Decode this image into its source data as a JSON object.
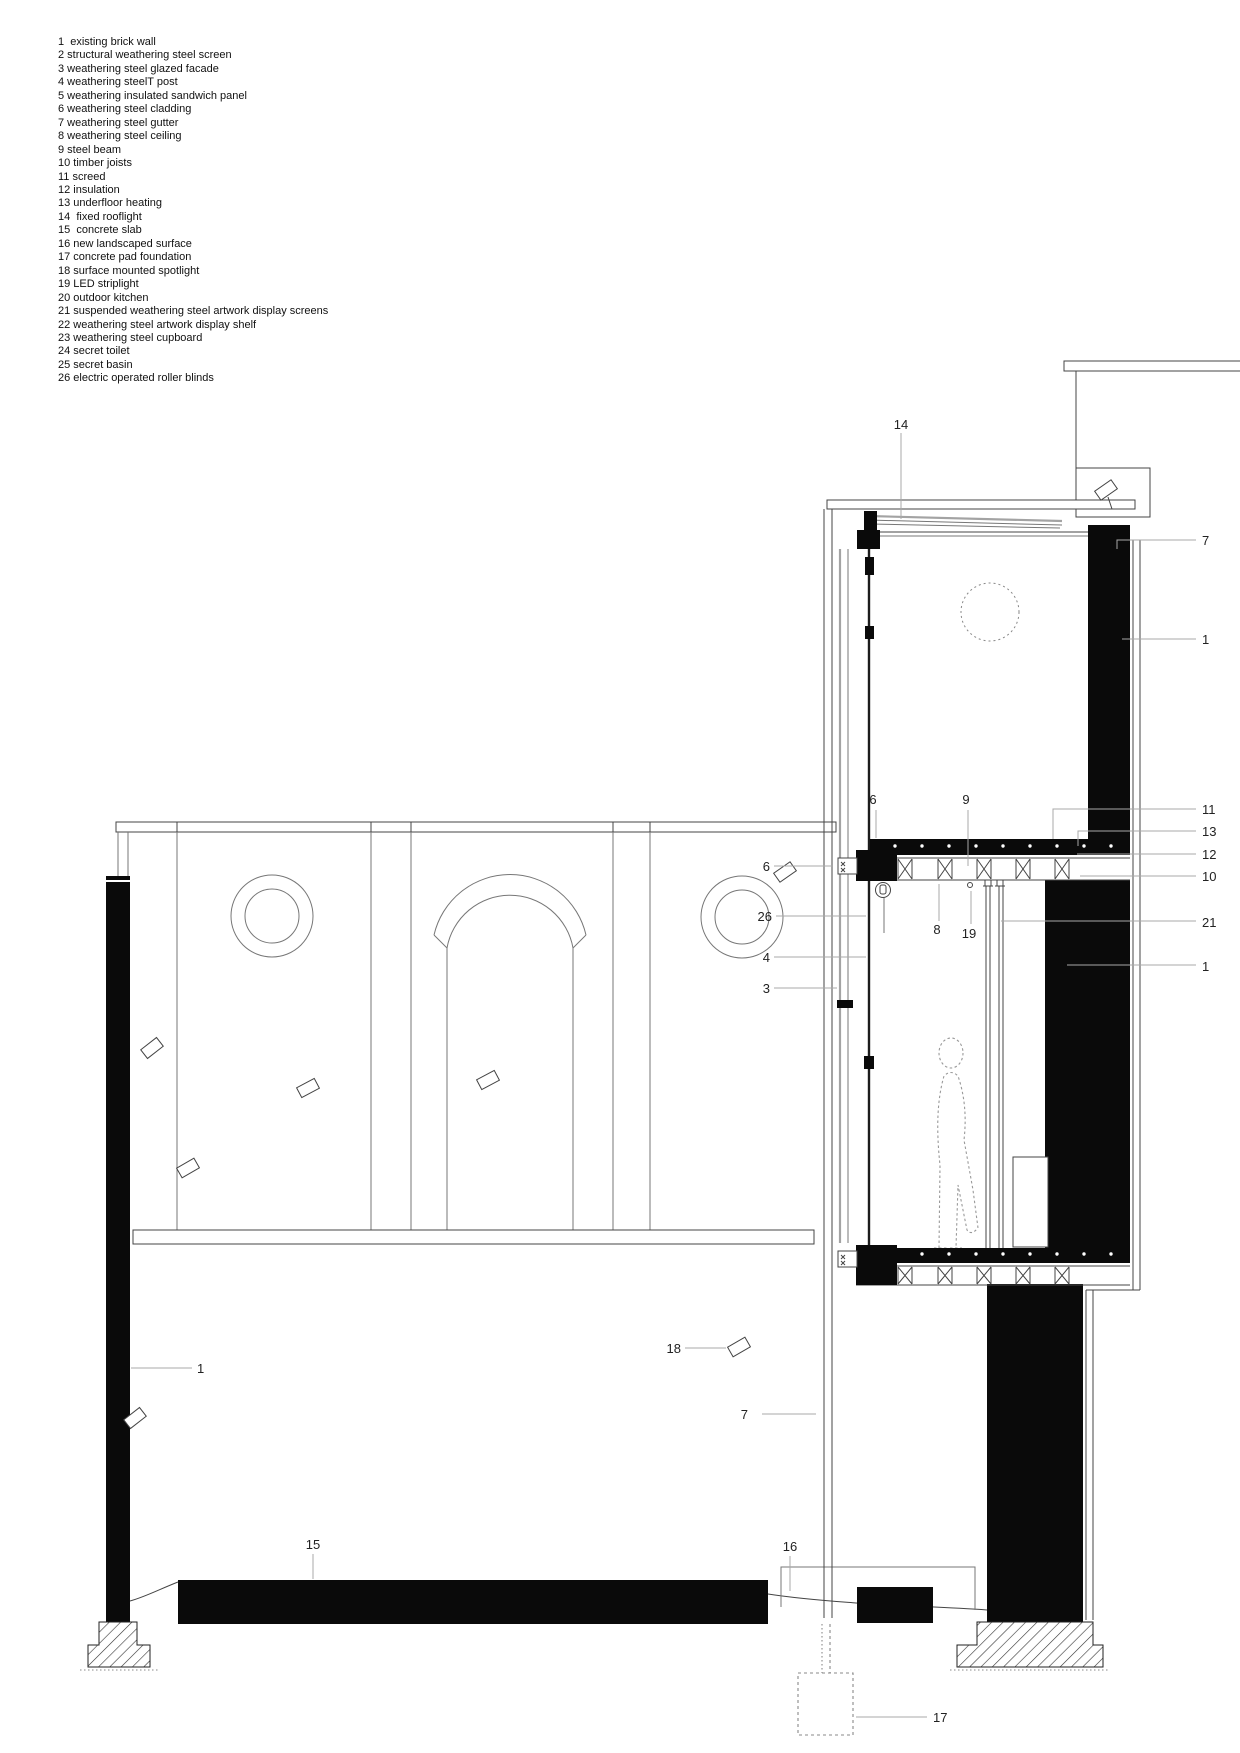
{
  "title": "architectural section detail drawing",
  "colors": {
    "bg": "#ffffff",
    "ink": "#111111",
    "line": "#444444",
    "leader": "#a8a8a8",
    "fill-black": "#0a0a0a"
  },
  "legend": {
    "lines": [
      "1  existing brick wall",
      "2 structural weathering steel screen",
      "3 weathering steel glazed facade",
      "4 weathering steelT post",
      "5 weathering insulated sandwich panel",
      "6 weathering steel cladding",
      "7 weathering steel gutter",
      "8 weathering steel ceiling",
      "9 steel beam",
      "10 timber joists",
      "11 screed",
      "12 insulation",
      "13 underfloor heating",
      "14  fixed rooflight",
      "15  concrete slab",
      "16 new landscaped surface",
      "17 concrete pad foundation",
      "18 surface mounted spotlight",
      "19 LED striplight",
      "20 outdoor kitchen",
      "21 suspended weathering steel artwork display screens",
      "22 weathering steel artwork display shelf",
      "23 weathering steel cupboard",
      "24 secret toilet",
      "25 secret basin",
      "26 electric operated roller blinds"
    ]
  },
  "callouts": {
    "c14": "14",
    "c7_top": "7",
    "c1_top": "1",
    "c6_floor": "6",
    "c9": "9",
    "c11": "11",
    "c13": "13",
    "c12": "12",
    "c10": "10",
    "c21": "21",
    "c1_mid": "1",
    "c8": "8",
    "c19": "19",
    "c6_wall": "6",
    "c26": "26",
    "c4": "4",
    "c3": "3",
    "c18": "18",
    "c1_left": "1",
    "c7_bottom": "7",
    "c15": "15",
    "c16": "16",
    "c17": "17"
  }
}
